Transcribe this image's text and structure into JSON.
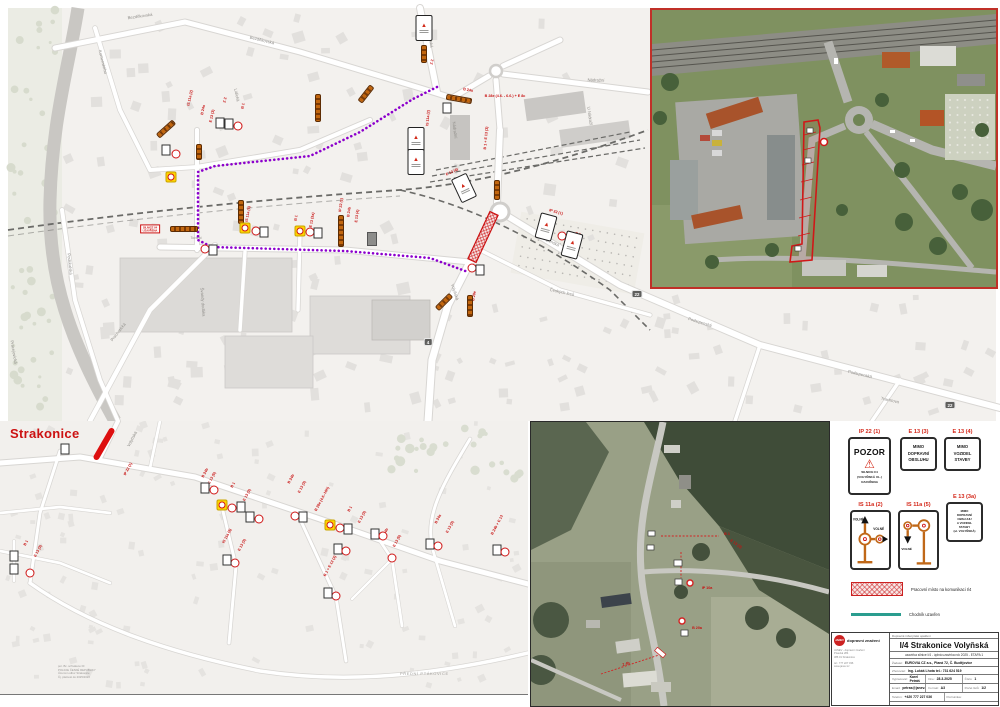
{
  "colors": {
    "purple_route": "#8c00cc",
    "closure_red": "#cc1111",
    "barrier_orange": "#c2660e",
    "legend_code_red": "#d4281a",
    "sidewalk_teal": "#2a9d8f",
    "yellow_sign": "#ffd400"
  },
  "top_map": {
    "closure_box": {
      "line1": "SILNICE I/4",
      "line2": "UZAVŘENA",
      "x": 150,
      "y": 229
    },
    "shields": [
      {
        "t": "22",
        "x": 637,
        "y": 294
      },
      {
        "t": "22",
        "x": 950,
        "y": 405
      },
      {
        "t": "4",
        "x": 428,
        "y": 342
      }
    ],
    "streets": [
      {
        "t": "Bezděkovská",
        "x": 140,
        "y": 16,
        "r": -8
      },
      {
        "t": "Bezděkovská",
        "x": 262,
        "y": 40,
        "r": 14
      },
      {
        "t": "Komenského",
        "x": 103,
        "y": 62,
        "r": 76
      },
      {
        "t": "Lidická",
        "x": 237,
        "y": 95,
        "r": 78
      },
      {
        "t": "Písecká",
        "x": 431,
        "y": 40,
        "r": 85
      },
      {
        "t": "Nádražní",
        "x": 596,
        "y": 80,
        "r": 2
      },
      {
        "t": "Nádražní",
        "x": 455,
        "y": 130,
        "r": 83
      },
      {
        "t": "U Nádraží",
        "x": 590,
        "y": 116,
        "r": 82
      },
      {
        "t": "Volyňská",
        "x": 455,
        "y": 292,
        "r": 72
      },
      {
        "t": "Podsrpenská",
        "x": 548,
        "y": 240,
        "r": 26
      },
      {
        "t": "Podsrpenská",
        "x": 700,
        "y": 322,
        "r": 17
      },
      {
        "t": "Podsrpenská",
        "x": 860,
        "y": 374,
        "r": 13
      },
      {
        "t": "Podskalská",
        "x": 70,
        "y": 264,
        "r": 84
      },
      {
        "t": "Prachatická",
        "x": 118,
        "y": 332,
        "r": -52
      },
      {
        "t": "Švandy dudáka",
        "x": 203,
        "y": 302,
        "r": 86
      },
      {
        "t": "Českých lesů",
        "x": 562,
        "y": 292,
        "r": 12
      },
      {
        "t": "Tovární",
        "x": 196,
        "y": 238,
        "r": 0,
        "s": 3.4
      },
      {
        "t": "Trachtova",
        "x": 890,
        "y": 400,
        "r": 12
      },
      {
        "t": "Pracejovická",
        "x": 14,
        "y": 352,
        "r": 80
      }
    ],
    "red_labels": [
      {
        "t": "B 28e (4.6. - 6.6.) + E 8c",
        "x": 505,
        "y": 96,
        "r": 0
      },
      {
        "t": "IS 11a (2)",
        "x": 190,
        "y": 98,
        "r": -78
      },
      {
        "t": "B 24a",
        "x": 203,
        "y": 110,
        "r": -78
      },
      {
        "t": "E 13 (3)",
        "x": 212,
        "y": 116,
        "r": -78
      },
      {
        "t": "Z 2",
        "x": 225,
        "y": 100,
        "r": -78
      },
      {
        "t": "B 1",
        "x": 243,
        "y": 106,
        "r": -78
      },
      {
        "t": "IP 22 (1)",
        "x": 341,
        "y": 205,
        "r": -82
      },
      {
        "t": "B 24b",
        "x": 349,
        "y": 212,
        "r": -82
      },
      {
        "t": "E 13 (4)",
        "x": 357,
        "y": 216,
        "r": -82
      },
      {
        "t": "IS 11a (5)",
        "x": 248,
        "y": 214,
        "r": -80
      },
      {
        "t": "B 1",
        "x": 296,
        "y": 218,
        "r": -80
      },
      {
        "t": "E 13 (3a)",
        "x": 312,
        "y": 220,
        "r": -80
      },
      {
        "t": "Z 2",
        "x": 432,
        "y": 62,
        "r": -80
      },
      {
        "t": "B 24a",
        "x": 468,
        "y": 90,
        "r": 10
      },
      {
        "t": "IP 22 (1)",
        "x": 556,
        "y": 212,
        "r": 15
      },
      {
        "t": "B 1",
        "x": 578,
        "y": 234,
        "r": 15
      },
      {
        "t": "E 13 (4)",
        "x": 452,
        "y": 172,
        "r": -25
      },
      {
        "t": "B 28e",
        "x": 474,
        "y": 296,
        "r": -80
      },
      {
        "t": "IS 11a (2)",
        "x": 428,
        "y": 118,
        "r": -85
      },
      {
        "t": "B 1 + E 13 (3)",
        "x": 486,
        "y": 138,
        "r": -85
      }
    ],
    "markers": [
      {
        "k": "barrier",
        "x": 166,
        "y": 129,
        "r": -42,
        "len": 20
      },
      {
        "k": "barrier",
        "x": 318,
        "y": 108,
        "r": 90,
        "len": 26
      },
      {
        "k": "barrier",
        "x": 424,
        "y": 54,
        "r": 90,
        "len": 16
      },
      {
        "k": "barrier",
        "x": 459,
        "y": 99,
        "r": 10,
        "len": 24
      },
      {
        "k": "barrier",
        "x": 366,
        "y": 94,
        "r": -52,
        "len": 18
      },
      {
        "k": "barrier",
        "x": 184,
        "y": 229,
        "r": 0,
        "len": 26
      },
      {
        "k": "barrier",
        "x": 241,
        "y": 212,
        "r": 90,
        "len": 22
      },
      {
        "k": "barrier",
        "x": 341,
        "y": 231,
        "r": 90,
        "len": 30
      },
      {
        "k": "barrier",
        "x": 497,
        "y": 190,
        "r": 90,
        "len": 18
      },
      {
        "k": "barrier",
        "x": 470,
        "y": 306,
        "r": 90,
        "len": 20
      },
      {
        "k": "barrier",
        "x": 444,
        "y": 302,
        "r": -45,
        "len": 18
      },
      {
        "k": "barrier",
        "x": 199,
        "y": 152,
        "r": 90,
        "len": 14
      },
      {
        "k": "ysign",
        "x": 171,
        "y": 177
      },
      {
        "k": "ysign",
        "x": 245,
        "y": 228
      },
      {
        "k": "ysign",
        "x": 300,
        "y": 231
      },
      {
        "k": "csign",
        "x": 176,
        "y": 154
      },
      {
        "k": "csign",
        "x": 256,
        "y": 231
      },
      {
        "k": "csign",
        "x": 310,
        "y": 232
      },
      {
        "k": "csign",
        "x": 205,
        "y": 249
      },
      {
        "k": "csign",
        "x": 472,
        "y": 268
      },
      {
        "k": "csign",
        "x": 562,
        "y": 236
      },
      {
        "k": "csign",
        "x": 238,
        "y": 126
      },
      {
        "k": "wsign",
        "x": 166,
        "y": 150
      },
      {
        "k": "wsign",
        "x": 264,
        "y": 232
      },
      {
        "k": "wsign",
        "x": 318,
        "y": 233
      },
      {
        "k": "wsign",
        "x": 213,
        "y": 250
      },
      {
        "k": "wsign",
        "x": 447,
        "y": 108
      },
      {
        "k": "wsign",
        "x": 480,
        "y": 270
      },
      {
        "k": "wsign",
        "x": 220,
        "y": 123
      },
      {
        "k": "wsign",
        "x": 229,
        "y": 124
      },
      {
        "k": "dsign",
        "x": 372,
        "y": 239
      },
      {
        "k": "bigsign",
        "x": 424,
        "y": 28,
        "r": 0
      },
      {
        "k": "bigsign",
        "x": 416,
        "y": 140,
        "r": 0
      },
      {
        "k": "bigsign",
        "x": 416,
        "y": 162,
        "r": 0
      },
      {
        "k": "bigsign",
        "x": 464,
        "y": 188,
        "r": -25
      },
      {
        "k": "bigsign",
        "x": 546,
        "y": 227,
        "r": 15
      },
      {
        "k": "bigsign",
        "x": 572,
        "y": 245,
        "r": 15
      }
    ]
  },
  "bottom_map": {
    "city": "Strakonice",
    "district": "PŘEDNÍ PTÁKOVICE",
    "stamp": [
      "por. Bc. schváleno DI",
      "POLICIE ČESKÉ REPUBLIKY",
      "Územní odbor Strakonice",
      "Čj. platnost do 2025/2026"
    ],
    "streets": [
      {
        "t": "Volyňská",
        "x": 132,
        "y": 18,
        "r": -62
      }
    ],
    "red_labels": [
      {
        "t": "IP 22 (1)",
        "x": 128,
        "y": 48,
        "r": -62
      },
      {
        "t": "B 24b",
        "x": 205,
        "y": 52,
        "r": -62
      },
      {
        "t": "E 13 (5)",
        "x": 212,
        "y": 57,
        "r": -62
      },
      {
        "t": "B 1",
        "x": 233,
        "y": 64,
        "r": -62
      },
      {
        "t": "E 13 (3)",
        "x": 247,
        "y": 74,
        "r": -62
      },
      {
        "t": "B 24b",
        "x": 291,
        "y": 58,
        "r": -62
      },
      {
        "t": "E 13 (3)",
        "x": 302,
        "y": 66,
        "r": -62
      },
      {
        "t": "B 28e (4.6.-16h)",
        "x": 322,
        "y": 78,
        "r": -62
      },
      {
        "t": "B 1",
        "x": 350,
        "y": 88,
        "r": -62
      },
      {
        "t": "E 13 (3)",
        "x": 362,
        "y": 96,
        "r": -62
      },
      {
        "t": "IS 11a (5)",
        "x": 227,
        "y": 115,
        "r": -62
      },
      {
        "t": "E 13 (3)",
        "x": 242,
        "y": 124,
        "r": -62
      },
      {
        "t": "B 1 + E 13 (3)",
        "x": 330,
        "y": 145,
        "r": -62
      },
      {
        "t": "B 24b",
        "x": 385,
        "y": 112,
        "r": -62
      },
      {
        "t": "E 13 (5)",
        "x": 397,
        "y": 120,
        "r": -62
      },
      {
        "t": "B 24a",
        "x": 438,
        "y": 98,
        "r": -62
      },
      {
        "t": "E 13 (3)",
        "x": 450,
        "y": 106,
        "r": -62
      },
      {
        "t": "B 24b + E 13",
        "x": 497,
        "y": 104,
        "r": -62
      },
      {
        "t": "B 1",
        "x": 26,
        "y": 122,
        "r": -62
      },
      {
        "t": "E 13 (3)",
        "x": 38,
        "y": 130,
        "r": -62
      }
    ],
    "markers": [
      {
        "k": "redbar",
        "x": 104,
        "y": 23,
        "r": 120,
        "len": 36
      },
      {
        "k": "ysign",
        "x": 222,
        "y": 84
      },
      {
        "k": "csign",
        "x": 232,
        "y": 87
      },
      {
        "k": "wsign",
        "x": 241,
        "y": 86
      },
      {
        "k": "wsign",
        "x": 205,
        "y": 67
      },
      {
        "k": "csign",
        "x": 214,
        "y": 69
      },
      {
        "k": "wsign",
        "x": 250,
        "y": 96
      },
      {
        "k": "csign",
        "x": 259,
        "y": 98
      },
      {
        "k": "csign",
        "x": 235,
        "y": 142
      },
      {
        "k": "wsign",
        "x": 227,
        "y": 139
      },
      {
        "k": "csign",
        "x": 295,
        "y": 95
      },
      {
        "k": "wsign",
        "x": 303,
        "y": 96
      },
      {
        "k": "ysign",
        "x": 330,
        "y": 104
      },
      {
        "k": "csign",
        "x": 340,
        "y": 107
      },
      {
        "k": "wsign",
        "x": 348,
        "y": 108
      },
      {
        "k": "wsign",
        "x": 338,
        "y": 128
      },
      {
        "k": "csign",
        "x": 346,
        "y": 130
      },
      {
        "k": "csign",
        "x": 336,
        "y": 175
      },
      {
        "k": "wsign",
        "x": 328,
        "y": 172
      },
      {
        "k": "wsign",
        "x": 375,
        "y": 113
      },
      {
        "k": "csign",
        "x": 383,
        "y": 115
      },
      {
        "k": "csign",
        "x": 392,
        "y": 137
      },
      {
        "k": "wsign",
        "x": 430,
        "y": 123
      },
      {
        "k": "csign",
        "x": 438,
        "y": 125
      },
      {
        "k": "wsign",
        "x": 497,
        "y": 129
      },
      {
        "k": "csign",
        "x": 505,
        "y": 131
      },
      {
        "k": "wsign",
        "x": 14,
        "y": 135
      },
      {
        "k": "wsign",
        "x": 14,
        "y": 148
      },
      {
        "k": "csign",
        "x": 30,
        "y": 152
      },
      {
        "k": "wsign",
        "x": 65,
        "y": 28
      }
    ]
  },
  "aerial_mid": {
    "red_labels": [
      {
        "t": "B 1",
        "x": 196,
        "y": 112,
        "r": 0
      },
      {
        "t": "E 13 (3)",
        "x": 205,
        "y": 122,
        "r": 35
      },
      {
        "t": "IP 10a",
        "x": 176,
        "y": 166,
        "r": 0
      },
      {
        "t": "B 20a",
        "x": 166,
        "y": 206,
        "r": 0
      },
      {
        "t": "Z 4b",
        "x": 95,
        "y": 242,
        "r": -18
      }
    ]
  },
  "legend": {
    "signs": [
      {
        "code": "IP 22 (1)",
        "pozor": "POZOR",
        "lines": [
          "SILNICE I/4",
          "(VOLYŇSKÁ UL.)",
          "UZAVŘENA"
        ]
      },
      {
        "code": "E 13 (3)",
        "lines": [
          "MIMO",
          "DOPRAVNÍ",
          "OBSLUHU"
        ]
      },
      {
        "code": "E 13 (4)",
        "lines": [
          "MIMO",
          "VOZIDEL",
          "STAVBY"
        ]
      },
      {
        "code": "IS 11a (2)",
        "note1": "VOLNÉ",
        "note2": "VOLNÉ"
      },
      {
        "code": "IS 11a (5)",
        "note1": "VOLNÉ"
      },
      {
        "code": "E 13 (3a)",
        "lines": [
          "MIMO",
          "DOPRAVNÍ",
          "OBSLUHU",
          "A VOZIDEL",
          "STAVBY",
          "(ul. VOLYŇSKÁ)"
        ]
      }
    ],
    "items": [
      {
        "label": "Pracovní místo na komunikaci I/4"
      },
      {
        "label": "Chodník uzavřen"
      }
    ]
  },
  "titleblock": {
    "header": "Dopravně inženýrské opatření",
    "title": "I/4 Strakonice Volyňská",
    "subtitle": "uzavírka silnice I/4 - úplná uzavírka rok 2025 - ETAPA 1",
    "applicant_label": "Žadatel:",
    "applicant": "EUROVIA CZ a.s., Planá 72, Č. Budějovice",
    "contractor_label": "Zhotovitel:",
    "contractor": "Ing. Lukáš Lhota    tel.: 731 624 519",
    "rows": [
      [
        {
          "l": "Vypracoval:",
          "v": "Karel Petráš"
        },
        {
          "l": "Dne:",
          "v": "28.3.2025"
        },
        {
          "l": "Číslo:",
          "v": "1"
        }
      ],
      [
        {
          "l": "Email:",
          "v": "petras@janev.cz"
        },
        {
          "l": "Formát:",
          "v": "A3"
        },
        {
          "l": "Počet listů:",
          "v": "1/2"
        }
      ],
      [
        {
          "l": "Telefon:",
          "v": "+420 777 227 036"
        },
        {
          "l": "Poznámka:",
          "v": ""
        }
      ]
    ]
  },
  "company": {
    "logo_text": "JANEV",
    "name": "dopravní značení",
    "lines": [
      "JANEV - dopravní značení",
      "Písecká 284",
      "386 01 Strakonice"
    ],
    "lines2": [
      "tel.: 777 227 036",
      "www.janev.cz"
    ]
  }
}
